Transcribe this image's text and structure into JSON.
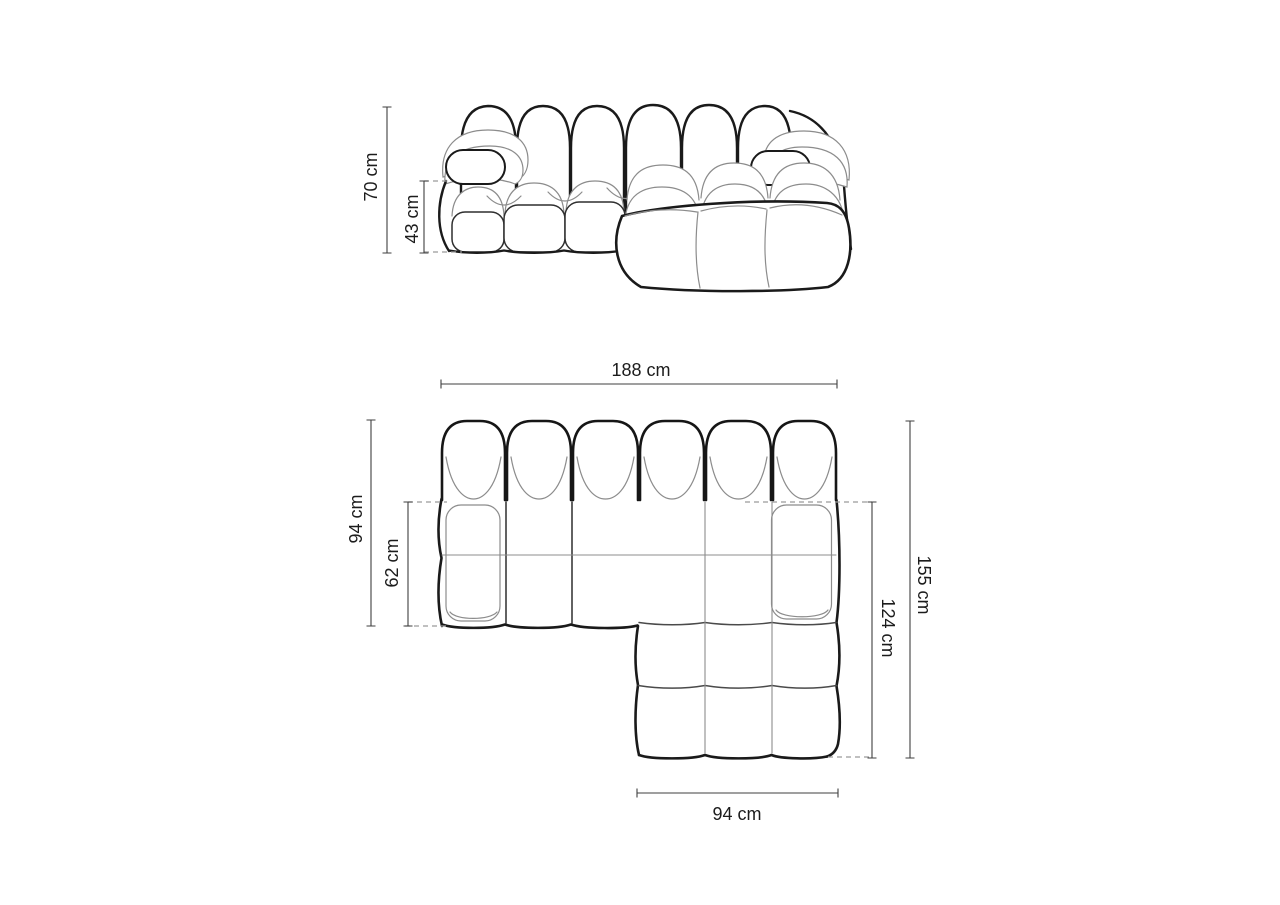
{
  "diagram": {
    "background": "#ffffff",
    "line_colors": {
      "outline": "#1a1a1a",
      "contour": "#8c8c8c",
      "dimension_line": "#3f3f3f",
      "dashed_reference": "#9a9a9a",
      "label_text": "#1c1c1c"
    },
    "front_view": {
      "dimensions": {
        "total_height": {
          "label": "70 cm",
          "value_cm": 70
        },
        "seat_height": {
          "label": "43 cm",
          "value_cm": 43
        }
      }
    },
    "top_view": {
      "dimensions": {
        "total_width": {
          "label": "188 cm",
          "value_cm": 188
        },
        "left_depth": {
          "label": "94 cm",
          "value_cm": 94
        },
        "seat_depth": {
          "label": "62 cm",
          "value_cm": 62
        },
        "right_total_depth": {
          "label": "155 cm",
          "value_cm": 155
        },
        "chaise_depth": {
          "label": "124 cm",
          "value_cm": 124
        },
        "chaise_width": {
          "label": "94 cm",
          "value_cm": 94
        }
      }
    }
  }
}
